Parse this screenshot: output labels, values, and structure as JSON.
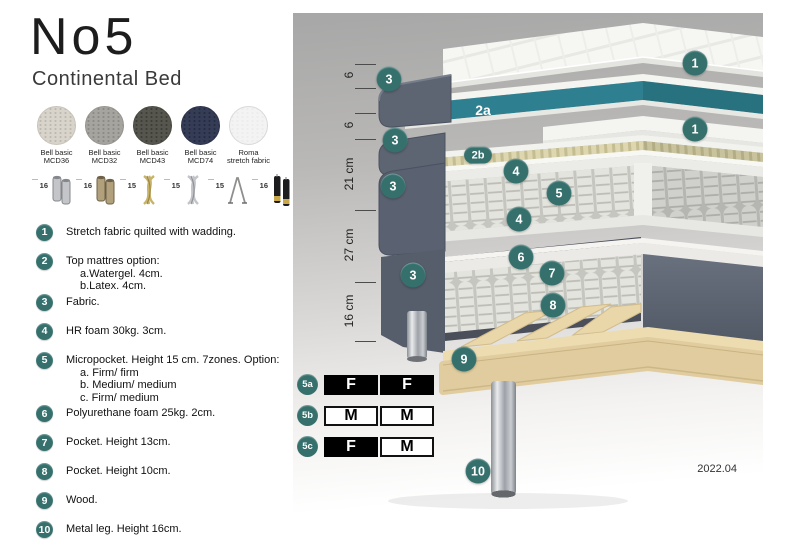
{
  "header": {
    "title": "No5",
    "subtitle": "Continental Bed"
  },
  "fabrics": [
    {
      "line1": "Bell basic",
      "line2": "MCD36",
      "base": "#d8d4cb",
      "dot": "#beb9af",
      "border": "#c9c4ba"
    },
    {
      "line1": "Bell basic",
      "line2": "MCD32",
      "base": "#a6a49f",
      "dot": "#8c8a85",
      "border": "#97948f"
    },
    {
      "line1": "Bell basic",
      "line2": "MCD43",
      "base": "#56564f",
      "dot": "#3e3e39",
      "border": "#4a4a44"
    },
    {
      "line1": "Bell basic",
      "line2": "MCD74",
      "base": "#353c56",
      "dot": "#252b41",
      "border": "#2d3349"
    },
    {
      "line1": "Roma",
      "line2": "stretch fabric",
      "base": "#f3f3f3",
      "dot": "#ececec",
      "border": "#d9d9d9"
    }
  ],
  "legs": [
    {
      "height": "16",
      "type": "cyl",
      "c1": "#c3c5c9",
      "c2": "#84878c"
    },
    {
      "height": "16",
      "type": "cyl",
      "c1": "#b0a07c",
      "c2": "#6f6147"
    },
    {
      "height": "15",
      "type": "twist",
      "c1": "#c8b368",
      "c2": "#9a8848"
    },
    {
      "height": "15",
      "type": "twist",
      "c1": "#c2c4c8",
      "c2": "#8f9297"
    },
    {
      "height": "15",
      "type": "hairpin",
      "c1": "#8f8f8d",
      "c2": "#6f6f6d"
    },
    {
      "height": "16",
      "type": "cyl2",
      "c1": "#1c1c1e",
      "c2": "#c9a84c"
    }
  ],
  "features": [
    {
      "num": "1",
      "text": "Stretch fabric quilted with wadding.",
      "sub": []
    },
    {
      "num": "2",
      "text": "Top mattres option:",
      "sub": [
        "a.Watergel. 4cm.",
        "b.Latex. 4cm."
      ]
    },
    {
      "num": "3",
      "text": "Fabric.",
      "sub": []
    },
    {
      "num": "4",
      "text": "HR foam 30kg. 3cm.",
      "sub": []
    },
    {
      "num": "5",
      "text": "Micropocket. Height 15 cm. 7zones. Option:",
      "sub": [
        "a. Firm/ firm",
        "b. Medium/ medium",
        "c. Firm/ medium"
      ]
    },
    {
      "num": "6",
      "text": "Polyurethane foam 25kg. 2cm.",
      "sub": []
    },
    {
      "num": "7",
      "text": "Pocket. Height 13cm.",
      "sub": []
    },
    {
      "num": "8",
      "text": "Pocket. Height 10cm.",
      "sub": []
    },
    {
      "num": "9",
      "text": "Wood.",
      "sub": []
    },
    {
      "num": "10",
      "text": "Metal leg. Height 16cm.",
      "sub": []
    }
  ],
  "diagram": {
    "callouts": [
      {
        "label": "1",
        "x": 402,
        "y": 50,
        "shape": "circle"
      },
      {
        "label": "3",
        "x": 96,
        "y": 66,
        "shape": "circle"
      },
      {
        "label": "2a",
        "x": 190,
        "y": 97,
        "shape": "text"
      },
      {
        "label": "1",
        "x": 402,
        "y": 116,
        "shape": "circle"
      },
      {
        "label": "3",
        "x": 102,
        "y": 127,
        "shape": "circle"
      },
      {
        "label": "2b",
        "x": 185,
        "y": 142,
        "shape": "pill"
      },
      {
        "label": "4",
        "x": 223,
        "y": 158,
        "shape": "circle"
      },
      {
        "label": "3",
        "x": 100,
        "y": 173,
        "shape": "circle"
      },
      {
        "label": "5",
        "x": 266,
        "y": 180,
        "shape": "circle"
      },
      {
        "label": "4",
        "x": 226,
        "y": 206,
        "shape": "circle"
      },
      {
        "label": "6",
        "x": 228,
        "y": 244,
        "shape": "circle"
      },
      {
        "label": "7",
        "x": 259,
        "y": 260,
        "shape": "circle"
      },
      {
        "label": "3",
        "x": 120,
        "y": 262,
        "shape": "circle"
      },
      {
        "label": "8",
        "x": 260,
        "y": 292,
        "shape": "circle"
      },
      {
        "label": "9",
        "x": 171,
        "y": 346,
        "shape": "circle"
      },
      {
        "label": "10",
        "x": 185,
        "y": 458,
        "shape": "circle"
      }
    ],
    "dimensions": [
      {
        "label": "6",
        "from": 51,
        "to": 75
      },
      {
        "label": "6",
        "from": 100,
        "to": 126
      },
      {
        "label": "21 cm",
        "from": 126,
        "to": 197
      },
      {
        "label": "27 cm",
        "from": 197,
        "to": 269
      },
      {
        "label": "16 cm",
        "from": 269,
        "to": 328
      }
    ],
    "version": "2022.04"
  },
  "firmness": {
    "rows": [
      {
        "label": "5a",
        "cells": [
          {
            "letter": "F",
            "dark": true
          },
          {
            "letter": "F",
            "dark": true
          }
        ]
      },
      {
        "label": "5b",
        "cells": [
          {
            "letter": "M",
            "dark": false
          },
          {
            "letter": "M",
            "dark": false
          }
        ]
      },
      {
        "label": "5c",
        "cells": [
          {
            "letter": "F",
            "dark": true
          },
          {
            "letter": "M",
            "dark": false
          }
        ]
      }
    ]
  },
  "colors": {
    "accent": "#35706d",
    "watergel_teal": "#2e7f8f",
    "latex": "#ddd6ae",
    "wood": "#e2cfa0",
    "fabric_gray": "#5c6370"
  }
}
